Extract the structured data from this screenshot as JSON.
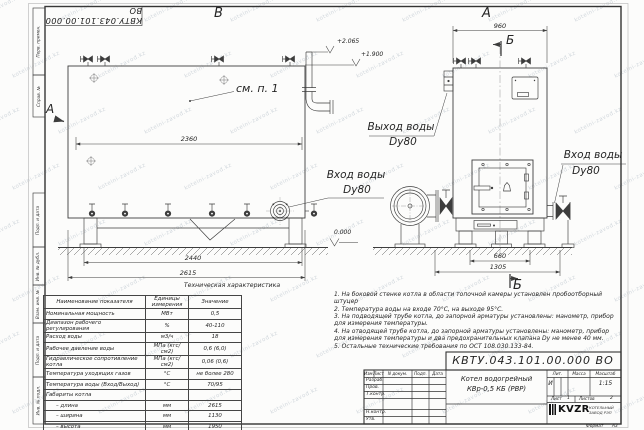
{
  "sheet": {
    "stamp_number": "КВТУ.043.101.00.000 ВО",
    "watermark": "kotelni-zavod.kz",
    "format_label": "Формат",
    "format_value": "А3"
  },
  "margin_labels": [
    "Перв. примен.",
    "Справ. №",
    "Подп. и дата",
    "Инв. № дубл.",
    "Взам. инв. №",
    "Подп. и дата",
    "Инв. № подл."
  ],
  "annotations": {
    "view_front_label": "В",
    "view_side_label": "А",
    "section_a": "А",
    "section_b_top": "Б",
    "section_b_bottom": "Б",
    "callout_note": "см. п. 1",
    "dim_2360": "2360",
    "dim_2440": "2440",
    "dim_2615": "2615",
    "dim_960": "960",
    "dim_660": "660",
    "dim_1305": "1305",
    "elev_top": "+2.065",
    "elev_mid": "+1.900",
    "elev_zero": "0.000",
    "outlet_line1": "Выход воды",
    "outlet_line2": "Dу80",
    "inlet_front_line1": "Вход воды",
    "inlet_front_line2": "Dу80",
    "inlet_side_line1": "Вход воды",
    "inlet_side_line2": "Dу80"
  },
  "spec_table": {
    "title": "Техническая характеристика",
    "headers": [
      "Наименование показателя",
      "Единицы измерения",
      "Значение"
    ],
    "rows": [
      [
        "Номинальная мощность",
        "МВт",
        "0,5"
      ],
      [
        "Диапазон рабочего регулирования",
        "%",
        "40-110"
      ],
      [
        "Расход воды",
        "м3/ч",
        "18"
      ],
      [
        "Рабочее давление воды",
        "МПа (кгс/см2)",
        "0,6 (6,0)"
      ],
      [
        "Гидравлическое сопротивление котла",
        "МПа (кгс/см2)",
        "0,06 (0,6)"
      ],
      [
        "Температура уходящих газов",
        "°С",
        "не более 280"
      ],
      [
        "Температура воды (Вход/Выход)",
        "°С",
        "70/95"
      ],
      [
        "Габариты котла",
        "",
        ""
      ],
      [
        "– длина",
        "мм",
        "2615"
      ],
      [
        "– ширина",
        "мм",
        "1130"
      ],
      [
        "– высота",
        "мм",
        "1950"
      ]
    ]
  },
  "notes": [
    "1. На боковой стенке котла в области топочной камеры установлен пробоотборный штуцер",
    "2. Температура воды на входе 70°С, на выходе 95°С.",
    "3. На подводящей трубе котла, до запорной арматуры установлены: манометр, прибор для измерения температуры.",
    "4. На отводящей трубе котла, до запорной арматуры установлены: манометр, прибор для измерения температуры и два предохранительных клапана Dу не менее 40 мм.",
    "5. Остальные технические требования по ОСТ 108.030.133-84."
  ],
  "title_block": {
    "doc_number": "КВТУ.043.101.00.000 ВО",
    "name_line1": "Котел водогрейный",
    "name_line2": "КВр-0,5 КБ (РВР)",
    "col_izm": "Изм.",
    "col_list": "Лист",
    "col_doc": "N докум.",
    "col_podp": "Подп.",
    "col_data": "Дата",
    "row_razrab": "Разраб.",
    "row_prov": "Пров.",
    "row_tkontr": "Т.контр.",
    "row_nkontr": "Н.контр.",
    "row_utv": "Утв.",
    "lit_label": "Лит.",
    "lit_value": "И",
    "mass_label": "Масса",
    "mass_value": "",
    "scale_label": "Масштаб",
    "scale_value": "1:15",
    "sheet_label": "Лист",
    "sheet_value": "1",
    "sheets_label": "Листов",
    "sheets_value": "2",
    "logo_text": "KVZR",
    "company_line1": "КОТЕЛЬНЫЙ",
    "company_line2": "ЗАВОД РЭП"
  }
}
